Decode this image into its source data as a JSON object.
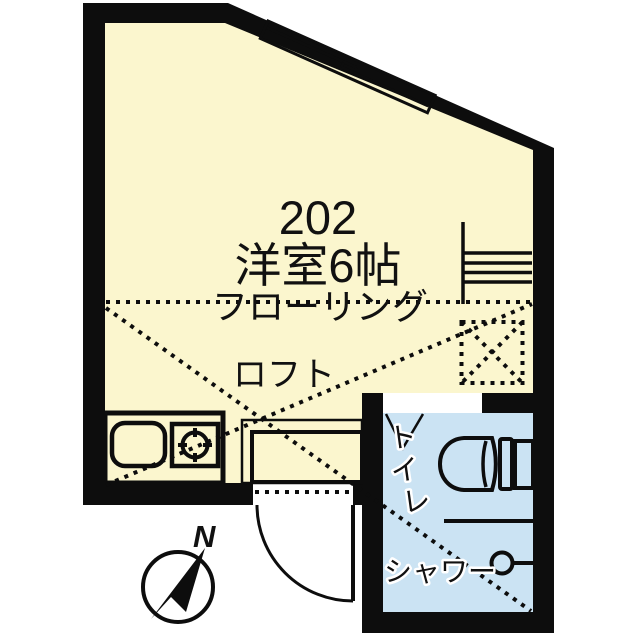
{
  "plan": {
    "unit_number": "202",
    "room_label": "洋室6帖",
    "flooring_label": "フローリング",
    "loft_label": "ロフト",
    "toilet_label_chars": [
      "ト",
      "イ",
      "レ"
    ],
    "shower_label": "シャワー",
    "compass_north_label": "N"
  },
  "colors": {
    "wall": "#0d0d0d",
    "room_floor": "#FBF6CE",
    "water_area": "#CBE3F3",
    "entry_step": "#D2D2D2",
    "entry_frame": "#F6ECDC",
    "background": "#FFFFFF"
  }
}
